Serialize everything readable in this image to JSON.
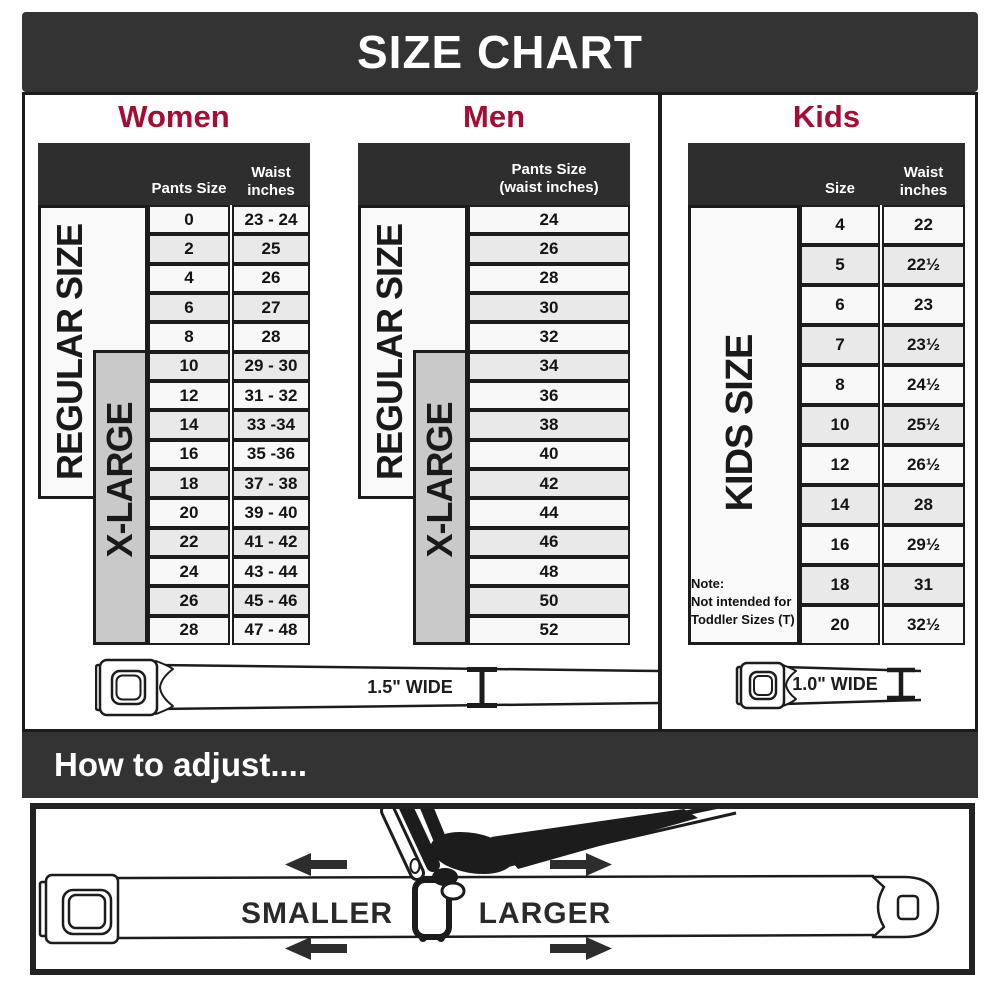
{
  "title": "SIZE CHART",
  "colors": {
    "banner": "#333333",
    "accent": "#a50d35",
    "table_header": "#2e2e2e",
    "table_border": "#1c1c1c",
    "xlarge_fill": "#c9c9c9",
    "row_light": "#f8f8f8",
    "row_alt": "#e9e9e9"
  },
  "sections": {
    "women": {
      "heading": "Women",
      "col1_label": "Pants Size",
      "col2_line1": "Waist",
      "col2_line2": "inches",
      "regular_label": "REGULAR SIZE",
      "xlarge_label": "X-LARGE",
      "rows": [
        {
          "size": "0",
          "waist": "23 - 24"
        },
        {
          "size": "2",
          "waist": "25"
        },
        {
          "size": "4",
          "waist": "26"
        },
        {
          "size": "6",
          "waist": "27"
        },
        {
          "size": "8",
          "waist": "28"
        },
        {
          "size": "10",
          "waist": "29 - 30"
        },
        {
          "size": "12",
          "waist": "31 - 32"
        },
        {
          "size": "14",
          "waist": "33 -34"
        },
        {
          "size": "16",
          "waist": "35 -36"
        },
        {
          "size": "18",
          "waist": "37 - 38"
        },
        {
          "size": "20",
          "waist": "39 - 40"
        },
        {
          "size": "22",
          "waist": "41 - 42"
        },
        {
          "size": "24",
          "waist": "43 - 44"
        },
        {
          "size": "26",
          "waist": "45 - 46"
        },
        {
          "size": "28",
          "waist": "47 - 48"
        }
      ],
      "belt_width_label": "1.5\" WIDE"
    },
    "men": {
      "heading": "Men",
      "col_line1": "Pants Size",
      "col_line2": "(waist inches)",
      "regular_label": "REGULAR SIZE",
      "xlarge_label": "X-LARGE",
      "rows": [
        "24",
        "26",
        "28",
        "30",
        "32",
        "34",
        "36",
        "38",
        "40",
        "42",
        "44",
        "46",
        "48",
        "50",
        "52"
      ]
    },
    "kids": {
      "heading": "Kids",
      "col1_label": "Size",
      "col2_line1": "Waist",
      "col2_line2": "inches",
      "side_label": "KIDS SIZE",
      "note_lines": [
        "Note:",
        "Not intended for",
        "Toddler Sizes (T)"
      ],
      "rows": [
        {
          "size": "4",
          "waist": "22"
        },
        {
          "size": "5",
          "waist": "22½"
        },
        {
          "size": "6",
          "waist": "23"
        },
        {
          "size": "7",
          "waist": "23½"
        },
        {
          "size": "8",
          "waist": "24½"
        },
        {
          "size": "10",
          "waist": "25½"
        },
        {
          "size": "12",
          "waist": "26½"
        },
        {
          "size": "14",
          "waist": "28"
        },
        {
          "size": "16",
          "waist": "29½"
        },
        {
          "size": "18",
          "waist": "31"
        },
        {
          "size": "20",
          "waist": "32½"
        }
      ],
      "belt_width_label": "1.0\" WIDE"
    }
  },
  "adjust": {
    "heading": "How to adjust....",
    "smaller_label": "SMALLER",
    "larger_label": "LARGER"
  },
  "chart_data": [
    {
      "type": "table",
      "title": "Women",
      "columns": [
        "Pants Size",
        "Waist inches"
      ],
      "rows": [
        [
          "0",
          "23 - 24"
        ],
        [
          "2",
          "25"
        ],
        [
          "4",
          "26"
        ],
        [
          "6",
          "27"
        ],
        [
          "8",
          "28"
        ],
        [
          "10",
          "29 - 30"
        ],
        [
          "12",
          "31 - 32"
        ],
        [
          "14",
          "33 -34"
        ],
        [
          "16",
          "35 -36"
        ],
        [
          "18",
          "37 - 38"
        ],
        [
          "20",
          "39 - 40"
        ],
        [
          "22",
          "41 - 42"
        ],
        [
          "24",
          "43 - 44"
        ],
        [
          "26",
          "45 - 46"
        ],
        [
          "28",
          "47 - 48"
        ]
      ],
      "groups": [
        {
          "label": "REGULAR SIZE",
          "size_range": "0-18"
        },
        {
          "label": "X-LARGE",
          "size_range": "10-28"
        }
      ],
      "belt_width": "1.5\" WIDE"
    },
    {
      "type": "table",
      "title": "Men",
      "columns": [
        "Pants Size (waist inches)"
      ],
      "rows": [
        [
          "24"
        ],
        [
          "26"
        ],
        [
          "28"
        ],
        [
          "30"
        ],
        [
          "32"
        ],
        [
          "34"
        ],
        [
          "36"
        ],
        [
          "38"
        ],
        [
          "40"
        ],
        [
          "42"
        ],
        [
          "44"
        ],
        [
          "46"
        ],
        [
          "48"
        ],
        [
          "50"
        ],
        [
          "52"
        ]
      ],
      "groups": [
        {
          "label": "REGULAR SIZE",
          "size_range": "24-42"
        },
        {
          "label": "X-LARGE",
          "size_range": "34-52"
        }
      ],
      "belt_width": "1.5\" WIDE"
    },
    {
      "type": "table",
      "title": "Kids",
      "columns": [
        "Size",
        "Waist inches"
      ],
      "rows": [
        [
          "4",
          "22"
        ],
        [
          "5",
          "22½"
        ],
        [
          "6",
          "23"
        ],
        [
          "7",
          "23½"
        ],
        [
          "8",
          "24½"
        ],
        [
          "10",
          "25½"
        ],
        [
          "12",
          "26½"
        ],
        [
          "14",
          "28"
        ],
        [
          "16",
          "29½"
        ],
        [
          "18",
          "31"
        ],
        [
          "20",
          "32½"
        ]
      ],
      "groups": [
        {
          "label": "KIDS SIZE",
          "size_range": "4-20"
        }
      ],
      "note": "Note: Not intended for Toddler Sizes (T)",
      "belt_width": "1.0\" WIDE"
    }
  ]
}
